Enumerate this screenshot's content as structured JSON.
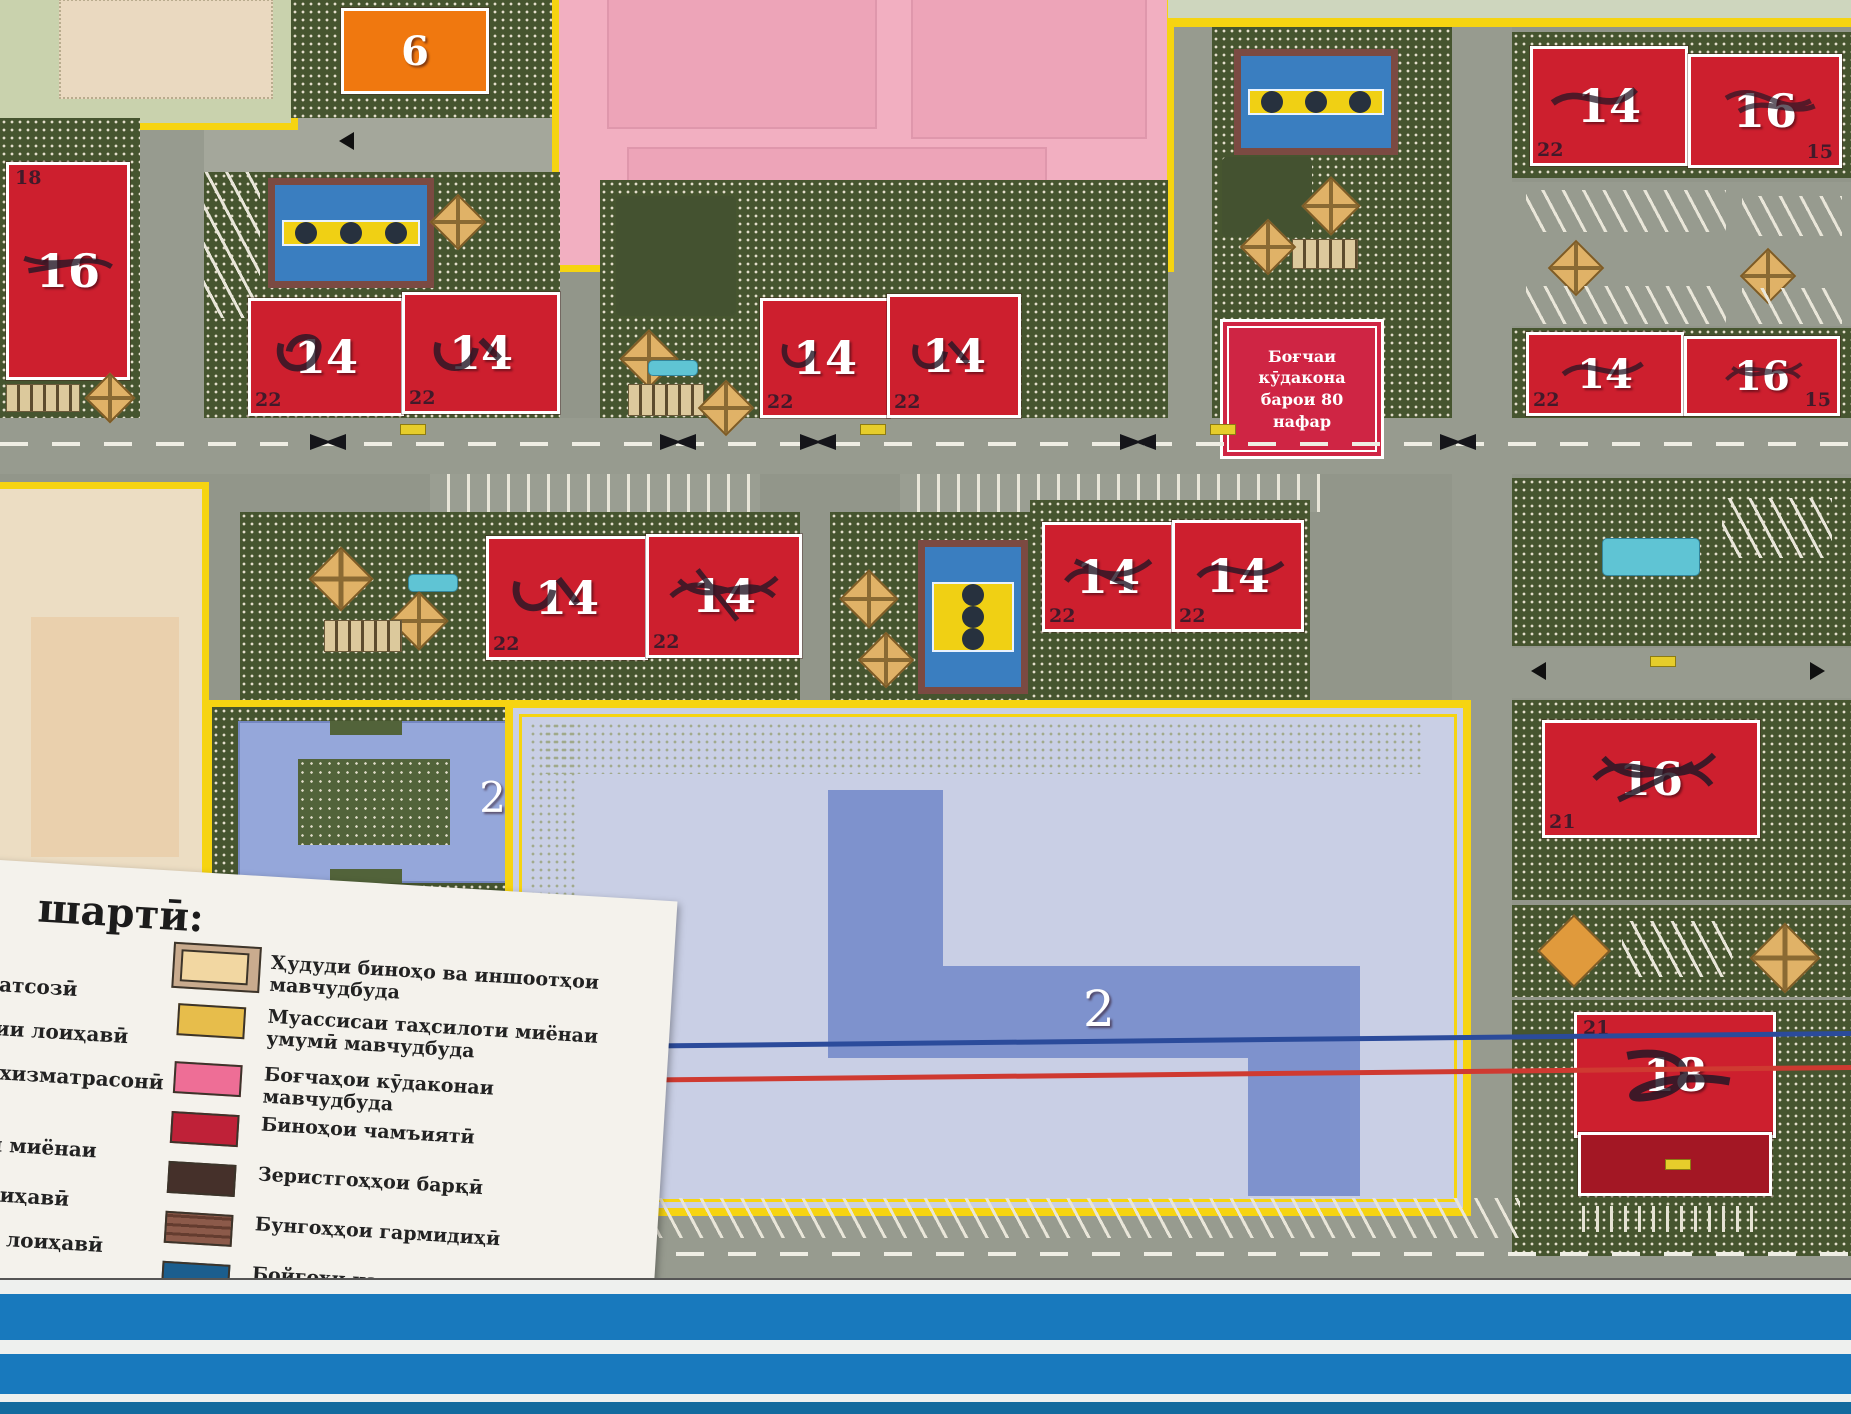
{
  "poster": {
    "legend": {
      "title": "шартӣ:",
      "left_column": [
        "ратсозӣ",
        "тии лоиҳавӣ",
        "а хизматрасонӣ",
        "ги миёнаи",
        "лоиҳавӣ",
        "ии лоиҳавӣ"
      ],
      "items": [
        {
          "label": "Ҳудуди биноҳо ва иншоотҳои мавчудбуда",
          "swatch_outer": "#c9ab8e",
          "swatch": "#f2d7a2"
        },
        {
          "label": "Муассисаи таҳсилоти миёнаи умумӣ мавчудбуда",
          "swatch": "#e7bd4b"
        },
        {
          "label": "Боғчаҳои кӯдаконаи мавчудбуда",
          "swatch": "#ee6e96"
        },
        {
          "label": "Биноҳои чамъиятӣ",
          "swatch": "#bf2138"
        },
        {
          "label": "Зеристгоҳҳои барқӣ",
          "swatch": "#45302a"
        },
        {
          "label": "Бунгоҳҳои гармидиҳӣ",
          "swatch": "#8c5a4a"
        },
        {
          "label": "Бойгоҳи насосҳо",
          "swatch": "#1b5e8e"
        }
      ]
    },
    "map": {
      "kindergarten_label": "Боғчаи кӯдакона барои 80 нафар",
      "colors": {
        "residential": "#cd1f2e",
        "residential_dark": "#a31724",
        "orange": "#f0780f",
        "school_blue": "#7e92cd",
        "block_blue": "#95a7da",
        "pink_zone": "#f2afc1",
        "pink_inner": "#eda4b8",
        "lavender": "#c9cfe5",
        "beige_zone": "#ecddc3",
        "pale_green": "#c9d2ad"
      },
      "buildings": [
        {
          "num": "16",
          "corner": "18"
        },
        {
          "num": "14",
          "corner": "22"
        },
        {
          "num": "14",
          "corner": "22"
        },
        {
          "num": "14",
          "corner": "22"
        },
        {
          "num": "14",
          "corner": "22"
        },
        {
          "num": "14",
          "corner": "22"
        },
        {
          "num": "16",
          "corner": "15"
        },
        {
          "num": "14",
          "corner": "22"
        },
        {
          "num": "16",
          "corner": "15"
        },
        {
          "num": "14",
          "corner": "22"
        },
        {
          "num": "14",
          "corner": "22"
        },
        {
          "num": "14",
          "corner": "22"
        },
        {
          "num": "14",
          "corner": "22"
        },
        {
          "num": "16",
          "corner": "21"
        },
        {
          "num": "18",
          "corner": "21"
        },
        {
          "num": "6",
          "corner": ""
        },
        {
          "num": "2",
          "corner": ""
        },
        {
          "num": "2",
          "corner": ""
        }
      ]
    }
  }
}
